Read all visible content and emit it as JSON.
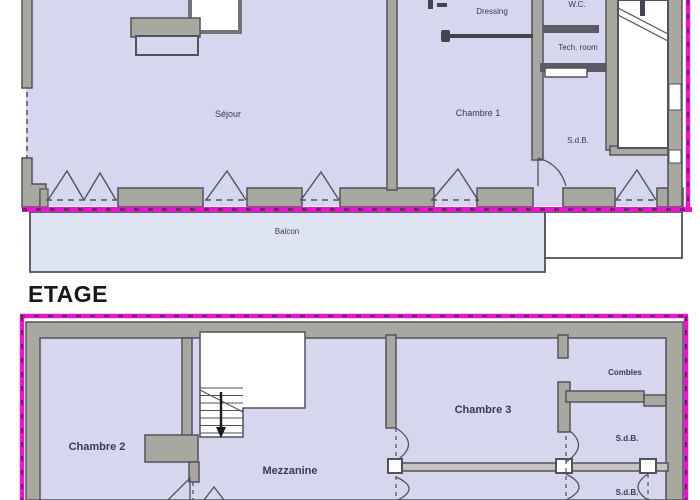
{
  "plan_top": {
    "rooms": {
      "sejour": "Séjour",
      "chambre_1": "Chambre  1",
      "dressing": "Dressing",
      "wc": "W.C.",
      "tech_room": "Tech. room",
      "sdb": "S.d.B.",
      "balcon": "Balcon"
    }
  },
  "plan_etage": {
    "title": "ETAGE",
    "rooms": {
      "chambre_2": "Chambre 2",
      "mezzanine": "Mezzanine",
      "chambre_3": "Chambre 3",
      "combles": "Combles",
      "sdb_top": "S.d.B.",
      "sdb_bottom": "S.d.B."
    }
  },
  "colors": {
    "room_fill": "#d6d7ee",
    "balcony_fill": "#dde3f1",
    "wall_fill": "#a9a8a0",
    "wall_outline": "#52525c",
    "property_line_magenta": "#e518cc",
    "property_line_dark_dash": "#5c2a5e",
    "label_text": "#3a3a52"
  }
}
